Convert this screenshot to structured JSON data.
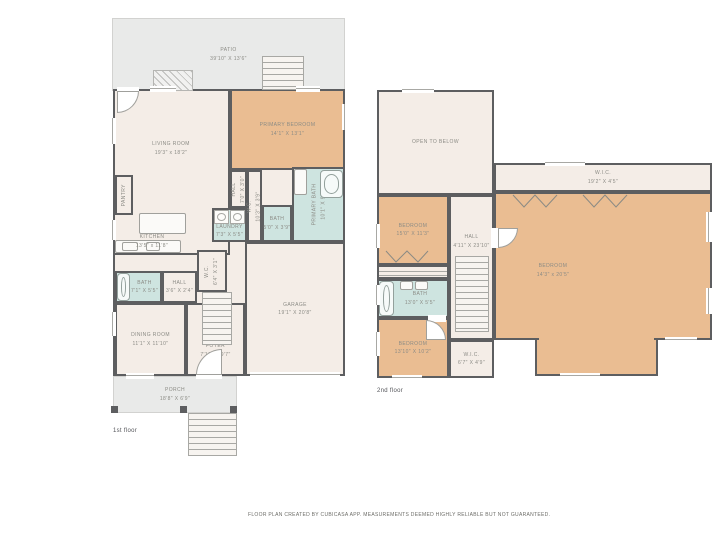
{
  "meta": {
    "floor1_label": "1st floor",
    "floor2_label": "2nd floor",
    "footer": "FLOOR PLAN CREATED BY CUBICASA APP. MEASUREMENTS DEEMED HIGHLY RELIABLE BUT NOT GUARANTEED."
  },
  "colors": {
    "wall": "#5d5e60",
    "floor_cream": "#f4ede7",
    "bedroom_tan": "#eabd92",
    "bath_blue": "#cee4e0",
    "outdoor_gray": "#e9eae9",
    "label_text": "#8b8b85"
  },
  "floor1": {
    "patio": {
      "name": "PATIO",
      "dims": "39'10\" x 13'6\""
    },
    "living_room": {
      "name": "LIVING ROOM",
      "dims": "19'3\" x 18'2\""
    },
    "kitchen": {
      "name": "KITCHEN",
      "dims": "13'5\" x 11'8\""
    },
    "pantry": {
      "name": "PANTRY"
    },
    "primary_bedroom": {
      "name": "PRIMARY BEDROOM",
      "dims": "14'1\" x 13'1\""
    },
    "hall_upper": {
      "name": "HALL",
      "dims": "7'0\" x 3'0\""
    },
    "wc_upper": {
      "name": "W.C.",
      "dims": "10'3\" x 3'9\""
    },
    "laundry": {
      "name": "LAUNDRY",
      "dims": "7'3\" x 5'5\""
    },
    "bath_small": {
      "name": "BATH",
      "dims": "5'0\" x 3'9\""
    },
    "primary_bath": {
      "name": "PRIMARY BATH",
      "dims": "10'1\" x 9'1\""
    },
    "wc_stairs": {
      "name": "W.C.",
      "dims": "6'4\" x 3'1\""
    },
    "bath_left": {
      "name": "BATH",
      "dims": "7'1\" x 5'5\""
    },
    "hall_lower": {
      "name": "HALL",
      "dims": "3'6\" x 2'4\""
    },
    "dining_room": {
      "name": "DINING ROOM",
      "dims": "11'1\" x 11'10\""
    },
    "foyer": {
      "name": "FOYER",
      "dims": "7'10\" x 9'7\""
    },
    "garage": {
      "name": "GARAGE",
      "dims": "19'1\" x 20'8\""
    },
    "porch": {
      "name": "PORCH",
      "dims": "18'8\" x 6'9\""
    }
  },
  "floor2": {
    "open_to_below": {
      "name": "OPEN TO BELOW"
    },
    "wic_top": {
      "name": "W.I.C.",
      "dims": "19'2\" x 4'5\""
    },
    "bedroom_left_top": {
      "name": "BEDROOM",
      "dims": "15'0\" x 11'3\""
    },
    "hall": {
      "name": "HALL",
      "dims": "4'11\" x 23'10\""
    },
    "bedroom_right": {
      "name": "BEDROOM",
      "dims": "14'3\" x 20'5\""
    },
    "bath": {
      "name": "BATH",
      "dims": "13'0\" x 5'5\""
    },
    "bedroom_left_bottom": {
      "name": "BEDROOM",
      "dims": "13'10\" x 10'2\""
    },
    "wic_small": {
      "name": "W.I.C.",
      "dims": "6'7\" x 4'9\""
    }
  }
}
